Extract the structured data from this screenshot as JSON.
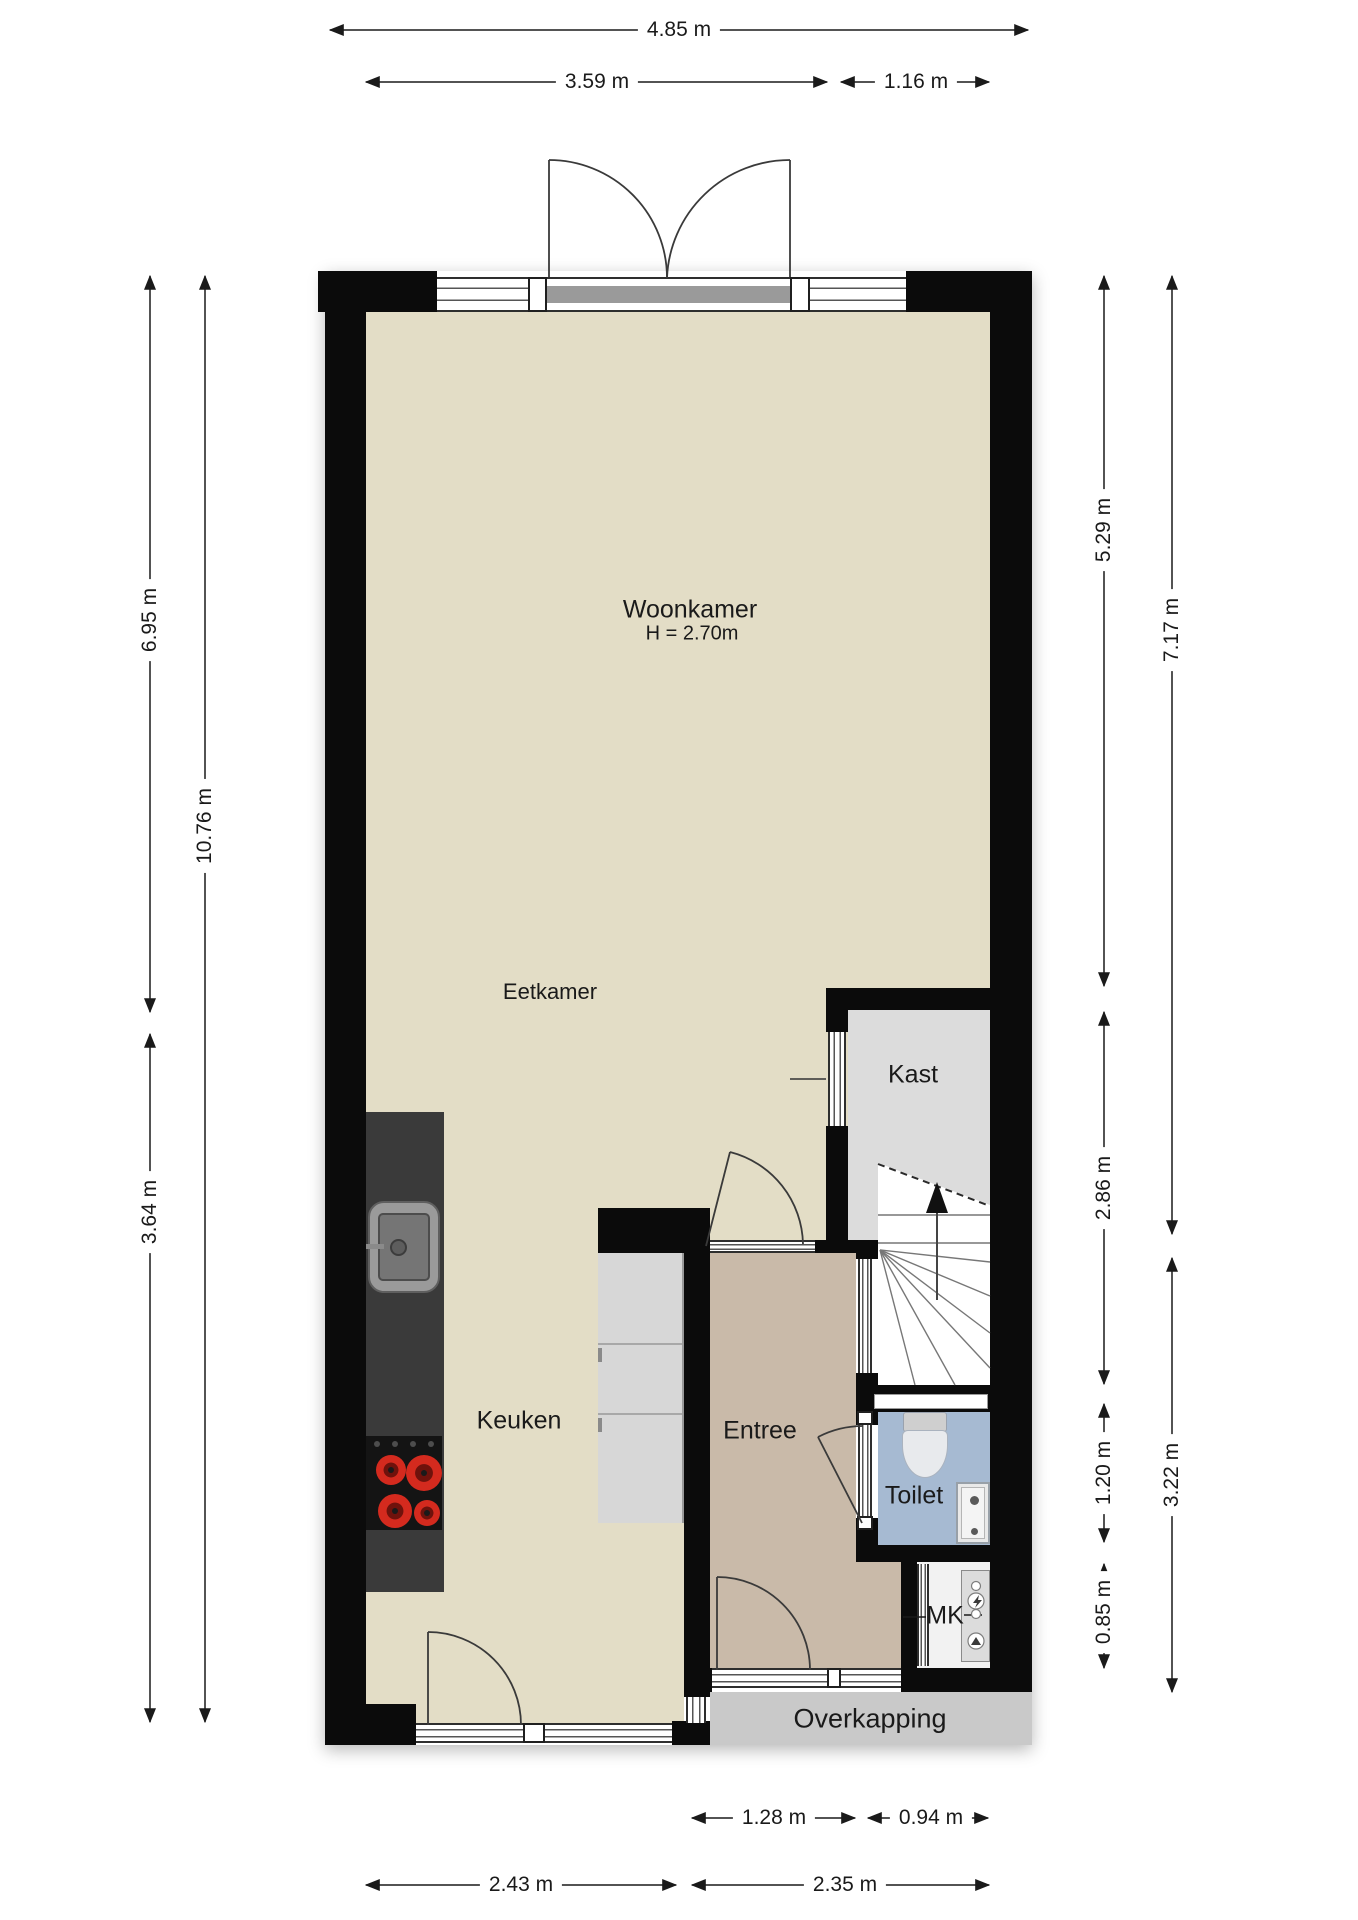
{
  "plan": {
    "type": "floorplan-ground-floor",
    "rooms": {
      "woonkamer": {
        "label": "Woonkamer",
        "height_note": "H = 2.70m"
      },
      "eetkamer": {
        "label": "Eetkamer"
      },
      "keuken": {
        "label": "Keuken"
      },
      "entree": {
        "label": "Entree"
      },
      "kast": {
        "label": "Kast"
      },
      "toilet": {
        "label": "Toilet"
      },
      "mk": {
        "label": "MK"
      },
      "overkapping": {
        "label": "Overkapping"
      }
    },
    "dimensions": {
      "top_total": "4.85 m",
      "top_left": "3.59 m",
      "top_right": "1.16 m",
      "left_upper": "6.95 m",
      "left_total": "10.76 m",
      "left_lower": "3.64 m",
      "right_upper": "5.29 m",
      "right_total_upper": "7.17 m",
      "right_mid": "2.86 m",
      "right_toilet": "1.20 m",
      "right_lower_total": "3.22 m",
      "right_mk": "0.85 m",
      "bottom_door": "1.28 m",
      "bottom_mk": "0.94 m",
      "bottom_keuken": "2.43 m",
      "bottom_entree": "2.35 m"
    },
    "colors": {
      "wall": "#0b0b0b",
      "floor_main": "#e3ddc6",
      "floor_entree": "#c9baa9",
      "floor_kast": "#dcdcdc",
      "floor_toilet": "#a6bad2",
      "overkapping": "#c9c9c9",
      "kitchen_counter": "#3a3a3a",
      "burner_red": "#d42a1e"
    }
  }
}
